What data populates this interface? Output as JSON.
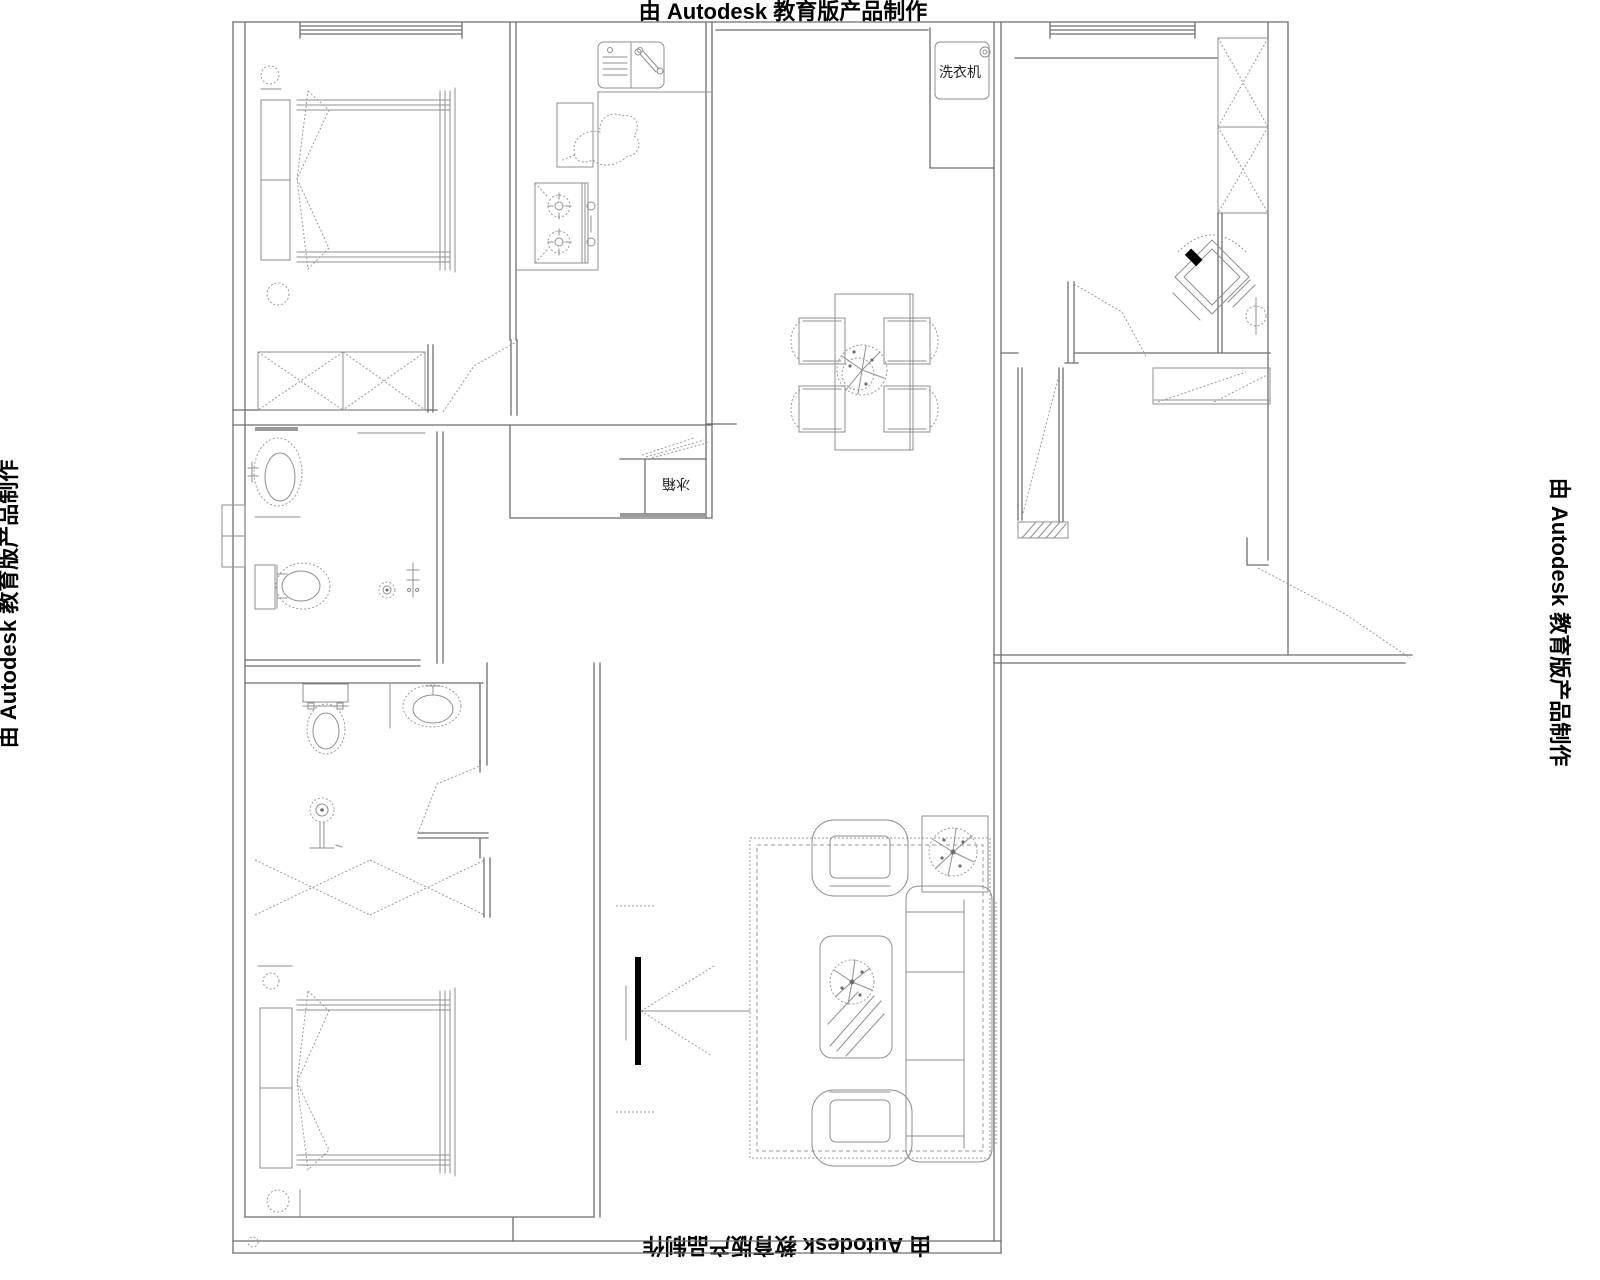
{
  "watermark": {
    "text": "由 Autodesk 教育版产品制作"
  },
  "labels": {
    "washing_machine": "洗衣机",
    "refrigerator": "冰箱"
  },
  "colors": {
    "background": "#ffffff",
    "wall_line": "#6e6e6e",
    "furniture_line": "#8f8f8f",
    "text": "#000000",
    "filled_accent": "#000000"
  },
  "symbols": [
    "window",
    "door-swing",
    "double-bed",
    "pillows",
    "bedside-lamp",
    "wardrobe-cross-box",
    "zigzag-wardrobe",
    "kitchen-sink",
    "gas-stove",
    "kettle-scribble",
    "refrigerator-box",
    "washing-machine-box",
    "dining-table",
    "dining-chair",
    "centerpiece-plant",
    "wash-basin",
    "toilet",
    "floor-drain",
    "shower-head",
    "swivel-chair",
    "floor-lamp",
    "shoe-cabinet",
    "sofa",
    "armchair",
    "coffee-table",
    "potted-plant",
    "area-rug",
    "balcony-door-fan",
    "wall-hatch",
    "pipe-shaft"
  ]
}
